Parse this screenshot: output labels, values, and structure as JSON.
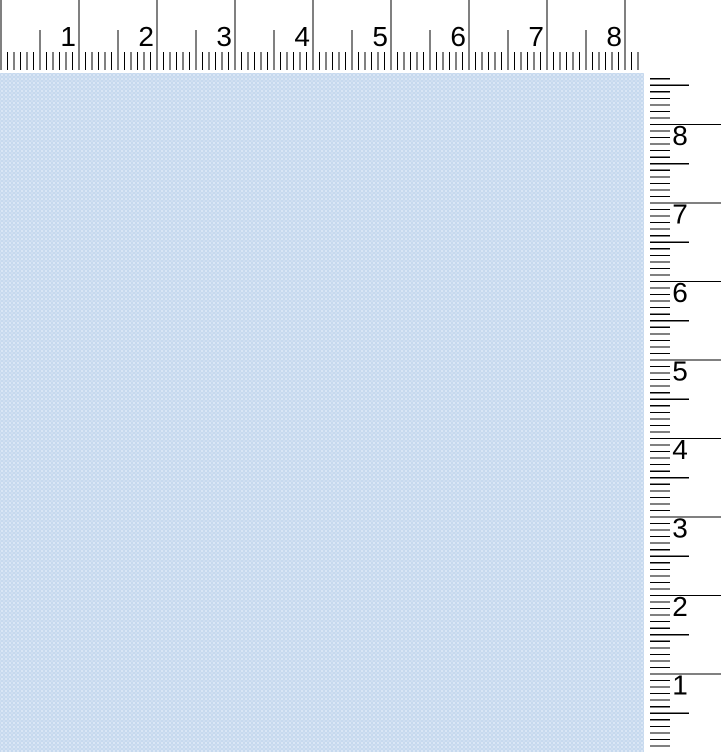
{
  "app": {
    "description": "Ruler measurement view over a blue page canvas",
    "background_color": "#ffffff"
  },
  "canvas": {
    "base_color": "#c6d9ee",
    "dot_color": "#dfeaf7"
  },
  "rulers": {
    "tick_color": "#000000",
    "label_color": "#000000",
    "label_font_size_px": 28,
    "horizontal": {
      "labels": [
        "1",
        "2",
        "3",
        "4",
        "5",
        "6",
        "7",
        "8"
      ],
      "origin_offset_px": 1,
      "unit_spacing_px": 78,
      "fine_divisions_per_unit": 12,
      "tick_count": 99,
      "fine_span": [
        52,
        70
      ],
      "medium_span": [
        30,
        70
      ],
      "major_span": [
        0,
        70
      ],
      "label_baseline_y": 46,
      "label_gap_px": 3
    },
    "vertical": {
      "labels": [
        "8",
        "7",
        "6",
        "5",
        "4",
        "3",
        "2",
        "1"
      ],
      "origin_abs_y": 752.5,
      "unit_spacing_px": 78.5,
      "fine_divisions_per_unit": 12,
      "top_limit_abs_y": 76,
      "ruler_top_abs_y": 73,
      "fine_span": [
        6,
        26
      ],
      "medium_span": [
        6,
        45
      ],
      "major_span": [
        6,
        77
      ],
      "label_center_x": 36,
      "label_baseline_offset": 20.5
    }
  }
}
